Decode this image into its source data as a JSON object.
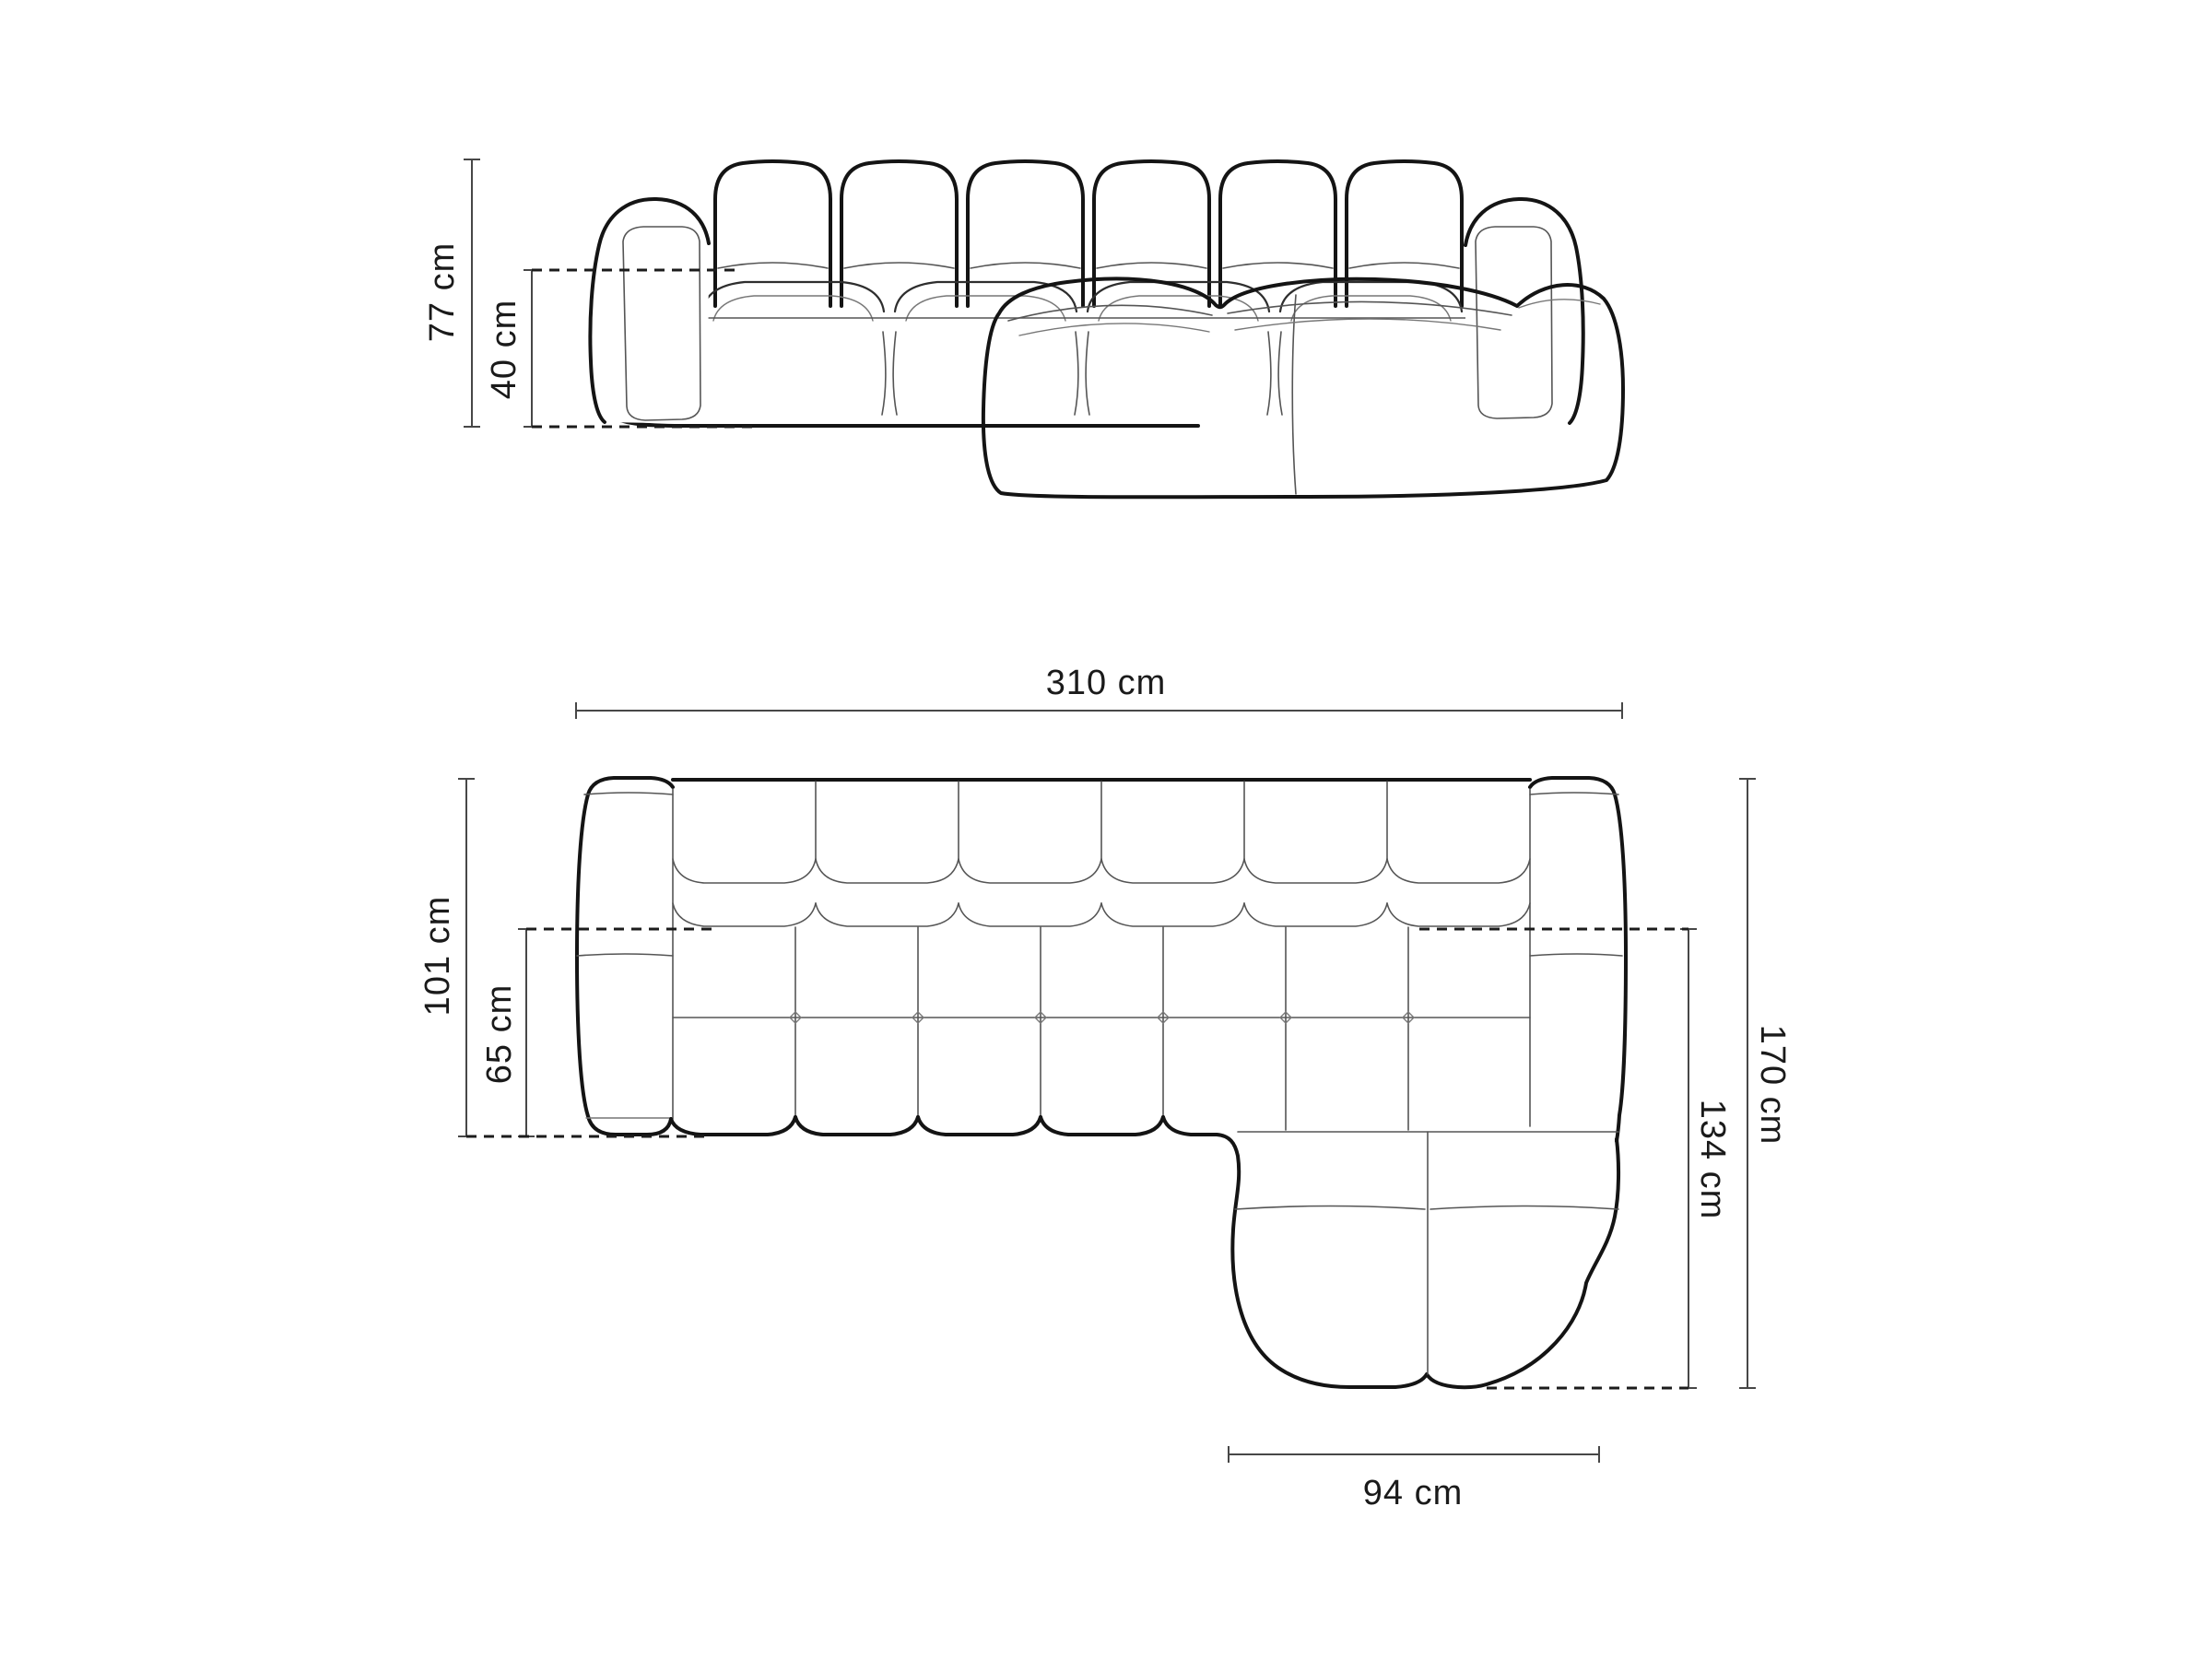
{
  "canvas": {
    "background": "#ffffff",
    "ink_color": "#141414",
    "dimension_line_color": "#474747",
    "label_color": "#1a1a1a"
  },
  "figure": {
    "subject": "modular corner sofa with right chaise",
    "views": [
      "front elevation",
      "top plan"
    ]
  },
  "measurements": {
    "front": {
      "total_height": "77 cm",
      "seat_height": "40 cm"
    },
    "plan": {
      "total_width": "310 cm",
      "body_depth": "101 cm",
      "seat_depth": "65 cm",
      "total_depth": "170 cm",
      "chaise_depth": "134 cm",
      "chaise_width": "94 cm"
    }
  }
}
